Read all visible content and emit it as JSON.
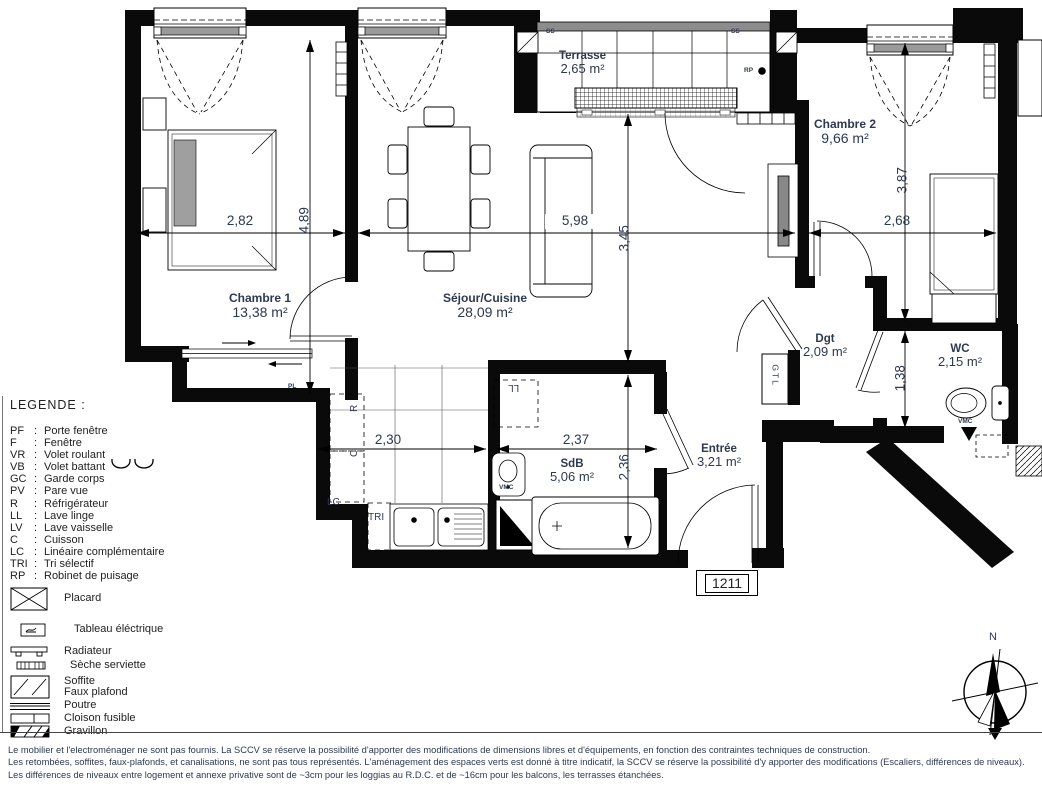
{
  "plan": {
    "rooms": {
      "chambre1": {
        "name": "Chambre 1",
        "area": "13,38 m²"
      },
      "sejour": {
        "name": "Séjour/Cuisine",
        "area": "28,09 m²"
      },
      "terrasse": {
        "name": "Terrasse",
        "area": "2,65 m²"
      },
      "chambre2": {
        "name": "Chambre 2",
        "area": "9,66 m²"
      },
      "dgt": {
        "name": "Dgt",
        "area": "2,09 m²"
      },
      "wc": {
        "name": "WC",
        "area": "2,15 m²"
      },
      "sdb": {
        "name": "SdB",
        "area": "5,06 m²"
      },
      "entree": {
        "name": "Entrée",
        "area": "3,21 m²"
      }
    },
    "dimensions": {
      "chambre1_width": "2,82",
      "chambre1_height": "4,89",
      "sejour_width": "5,98",
      "sejour_height": "3,45",
      "chambre2_height": "3,87",
      "chambre2_width": "2,68",
      "cuisine_width": "2,30",
      "sdb_width": "2,37",
      "sdb_height": "2,36",
      "wc_height": "1,38"
    },
    "annotations": {
      "pl": "PL",
      "gtl": "GTL",
      "lc": "LC",
      "tri": "TRI",
      "refrigerateur": "R",
      "cuisson": "C",
      "lave_linge": "LL",
      "vmc_sdb": "VMC",
      "vmc_wc": "VMC",
      "ss_left": "SS",
      "ss_right": "SS",
      "rp": "RP"
    },
    "lot_number": "1211",
    "compass_north": "N"
  },
  "legend": {
    "title": "LEGENDE  :",
    "abbreviations": [
      {
        "abbr": "PF",
        "label": "Porte fenêtre"
      },
      {
        "abbr": "F",
        "label": "Fenêtre"
      },
      {
        "abbr": "VR",
        "label": "Volet roulant"
      },
      {
        "abbr": "VB",
        "label": "Volet battant"
      },
      {
        "abbr": "GC",
        "label": "Garde corps"
      },
      {
        "abbr": "PV",
        "label": "Pare vue"
      },
      {
        "abbr": "R",
        "label": "Réfrigérateur"
      },
      {
        "abbr": "LL",
        "label": "Lave linge"
      },
      {
        "abbr": "LV",
        "label": "Lave vaisselle"
      },
      {
        "abbr": "C",
        "label": "Cuisson"
      },
      {
        "abbr": "LC",
        "label": "Linéaire complémentaire"
      },
      {
        "abbr": "TRI",
        "label": "Tri sélectif"
      },
      {
        "abbr": "RP",
        "label": "Robinet de puisage"
      }
    ],
    "symbols": [
      {
        "icon": "placard-icon",
        "label": "Placard"
      },
      {
        "icon": "tableau-electrique-icon",
        "label": "Tableau éléctrique"
      },
      {
        "icon": "radiateur-icon",
        "label": "Radiateur"
      },
      {
        "icon": "seche-serviette-icon",
        "label": "Sèche serviette"
      },
      {
        "icon": "soffite-faux-plafond-icon",
        "label": "Soffite",
        "label2": "Faux plafond"
      },
      {
        "icon": "poutre-icon",
        "label": "Poutre"
      },
      {
        "icon": "cloison-fusible-icon",
        "label": "Cloison fusible"
      },
      {
        "icon": "gravillon-icon",
        "label": "Gravillon"
      }
    ]
  },
  "footer": {
    "line1": "Le mobilier et l'electroménager ne sont pas fournis. La SCCV se réserve la possibilité d'apporter des modifications de dimensions libres  et d'équipements, en fonction des contraintes techniques de construction.",
    "line2": "Les retombées, soffites, faux-plafonds, et canalisations, ne sont pas tous représentés. L'aménagement des espaces verts est donné à titre indicatif, la SCCV se réserve la possibilité d'y apporter des modifications (Escaliers, différences de niveaux).",
    "line3": "Les différences de niveaux entre logement et annexe privative sont de ~3cm pour les loggias au R.D.C. et de ~16cm pour les balcons, les terrasses étanchées."
  }
}
